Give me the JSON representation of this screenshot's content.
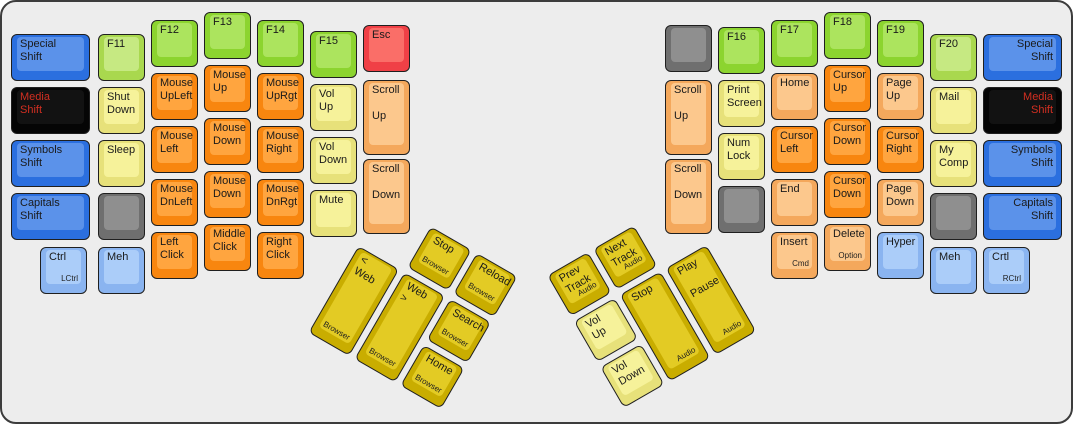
{
  "title": "ErgoDox media layer keyboard diagram",
  "palette": {
    "blue": {
      "base": "#2b6fdf",
      "top": "#5b92ea"
    },
    "lightblue": {
      "base": "#8ab4f0",
      "top": "#abcdf9"
    },
    "black": {
      "base": "#050505",
      "top": "#121212"
    },
    "green": {
      "base": "#8cd42f",
      "top": "#ace45e"
    },
    "ygreen": {
      "base": "#a9d84e",
      "top": "#c6e982"
    },
    "orange": {
      "base": "#f8860f",
      "top": "#ffa53f"
    },
    "peach": {
      "base": "#f4a85c",
      "top": "#fcc88d"
    },
    "paleyellow": {
      "base": "#e7e17a",
      "top": "#f6f29a"
    },
    "gold": {
      "base": "#c9ad00",
      "top": "#e3cb24"
    },
    "red": {
      "base": "#f04046",
      "top": "#fa6e68"
    },
    "gray": {
      "base": "#6f6f6f",
      "top": "#8f8f8f"
    }
  },
  "text_colors": {
    "default": "#1a1a1a",
    "red": "#d22f21"
  },
  "board": {
    "width": 1069,
    "height": 420,
    "background": "#ededed",
    "key_unit": 53,
    "key_size": 47
  },
  "groups": [
    {
      "name": "left-main",
      "type": "flat",
      "keys": [
        {
          "id": "special-shift-left",
          "x": 9,
          "y": 32,
          "w": 79,
          "c": "blue",
          "t": "Special\nShift"
        },
        {
          "id": "media-shift-left",
          "x": 9,
          "y": 85,
          "w": 79,
          "c": "black",
          "t": "Media\nShift",
          "tc": "red"
        },
        {
          "id": "symbols-shift-left",
          "x": 9,
          "y": 138,
          "w": 79,
          "c": "blue",
          "t": "Symbols\nShift"
        },
        {
          "id": "capitals-shift-left",
          "x": 9,
          "y": 191,
          "w": 79,
          "c": "blue",
          "t": "Capitals\nShift"
        },
        {
          "id": "lctrl",
          "x": 38,
          "y": 245,
          "c": "lightblue",
          "t": "Ctrl",
          "s": "LCtrl",
          "sp": "br"
        },
        {
          "id": "f11",
          "x": 96,
          "y": 32,
          "c": "ygreen",
          "t": "F11"
        },
        {
          "id": "shut-down",
          "x": 96,
          "y": 85,
          "c": "paleyellow",
          "t": "Shut\nDown"
        },
        {
          "id": "sleep",
          "x": 96,
          "y": 138,
          "c": "paleyellow",
          "t": "Sleep"
        },
        {
          "id": "blank-left",
          "x": 96,
          "y": 191,
          "c": "gray",
          "t": ""
        },
        {
          "id": "meh-left",
          "x": 96,
          "y": 245,
          "c": "lightblue",
          "t": "Meh"
        },
        {
          "id": "f12",
          "x": 149,
          "y": 18,
          "c": "green",
          "t": "F12"
        },
        {
          "id": "mouse-upleft",
          "x": 149,
          "y": 71,
          "c": "orange",
          "t": "Mouse\nUpLeft"
        },
        {
          "id": "mouse-left",
          "x": 149,
          "y": 124,
          "c": "orange",
          "t": "Mouse\nLeft"
        },
        {
          "id": "mouse-dnleft",
          "x": 149,
          "y": 177,
          "c": "orange",
          "t": "Mouse\nDnLeft"
        },
        {
          "id": "left-click",
          "x": 149,
          "y": 230,
          "c": "orange",
          "t": "Left\nClick"
        },
        {
          "id": "f13",
          "x": 202,
          "y": 10,
          "c": "green",
          "t": "F13"
        },
        {
          "id": "mouse-up",
          "x": 202,
          "y": 63,
          "c": "orange",
          "t": "Mouse\nUp"
        },
        {
          "id": "mouse-down-1",
          "x": 202,
          "y": 116,
          "c": "orange",
          "t": "Mouse\nDown"
        },
        {
          "id": "mouse-down-2",
          "x": 202,
          "y": 169,
          "c": "orange",
          "t": "Mouse\nDown"
        },
        {
          "id": "middle-click",
          "x": 202,
          "y": 222,
          "c": "orange",
          "t": "Middle\nClick"
        },
        {
          "id": "f14",
          "x": 255,
          "y": 18,
          "c": "green",
          "t": "F14"
        },
        {
          "id": "mouse-uprgt",
          "x": 255,
          "y": 71,
          "c": "orange",
          "t": "Mouse\nUpRgt"
        },
        {
          "id": "mouse-right",
          "x": 255,
          "y": 124,
          "c": "orange",
          "t": "Mouse\nRight"
        },
        {
          "id": "mouse-dnrgt",
          "x": 255,
          "y": 177,
          "c": "orange",
          "t": "Mouse\nDnRgt"
        },
        {
          "id": "right-click",
          "x": 255,
          "y": 230,
          "c": "orange",
          "t": "Right\nClick"
        },
        {
          "id": "f15",
          "x": 308,
          "y": 29,
          "c": "green",
          "t": "F15"
        },
        {
          "id": "vol-up-left",
          "x": 308,
          "y": 82,
          "c": "paleyellow",
          "t": "Vol\nUp"
        },
        {
          "id": "vol-down-left",
          "x": 308,
          "y": 135,
          "c": "paleyellow",
          "t": "Vol\nDown"
        },
        {
          "id": "mute",
          "x": 308,
          "y": 188,
          "c": "paleyellow",
          "t": "Mute"
        },
        {
          "id": "esc",
          "x": 361,
          "y": 23,
          "c": "red",
          "t": "Esc"
        },
        {
          "id": "scroll-up-left",
          "x": 361,
          "y": 78,
          "h": 75,
          "c": "peach",
          "t": "Scroll\n\nUp"
        },
        {
          "id": "scroll-down-left",
          "x": 361,
          "y": 157,
          "h": 75,
          "c": "peach",
          "t": "Scroll\n\nDown"
        }
      ]
    },
    {
      "name": "right-main",
      "type": "flat",
      "keys": [
        {
          "id": "blank-right-top",
          "x": 663,
          "y": 23,
          "c": "gray",
          "t": ""
        },
        {
          "id": "scroll-up-right",
          "x": 663,
          "y": 78,
          "h": 75,
          "c": "peach",
          "t": "Scroll\n\nUp"
        },
        {
          "id": "scroll-down-right",
          "x": 663,
          "y": 157,
          "h": 75,
          "c": "peach",
          "t": "Scroll\n\nDown"
        },
        {
          "id": "f16",
          "x": 716,
          "y": 25,
          "c": "green",
          "t": "F16"
        },
        {
          "id": "print-screen",
          "x": 716,
          "y": 78,
          "c": "paleyellow",
          "t": "Print\nScreen"
        },
        {
          "id": "num-lock",
          "x": 716,
          "y": 131,
          "c": "paleyellow",
          "t": "Num\nLock"
        },
        {
          "id": "blank-right-mid",
          "x": 716,
          "y": 184,
          "c": "gray",
          "t": ""
        },
        {
          "id": "f17",
          "x": 769,
          "y": 18,
          "c": "green",
          "t": "F17"
        },
        {
          "id": "home-right",
          "x": 769,
          "y": 71,
          "c": "peach",
          "t": "Home"
        },
        {
          "id": "cursor-left",
          "x": 769,
          "y": 124,
          "c": "orange",
          "t": "Cursor\nLeft"
        },
        {
          "id": "end",
          "x": 769,
          "y": 177,
          "c": "peach",
          "t": "End"
        },
        {
          "id": "insert",
          "x": 769,
          "y": 230,
          "c": "peach",
          "t": "Insert",
          "s": "Cmd",
          "sp": "br"
        },
        {
          "id": "f18",
          "x": 822,
          "y": 10,
          "c": "green",
          "t": "F18"
        },
        {
          "id": "cursor-up",
          "x": 822,
          "y": 63,
          "c": "orange",
          "t": "Cursor\nUp"
        },
        {
          "id": "cursor-down-1",
          "x": 822,
          "y": 116,
          "c": "orange",
          "t": "Cursor\nDown"
        },
        {
          "id": "cursor-down-2",
          "x": 822,
          "y": 169,
          "c": "orange",
          "t": "Cursor\nDown"
        },
        {
          "id": "delete",
          "x": 822,
          "y": 222,
          "c": "peach",
          "t": "Delete",
          "s": "Option",
          "sp": "br"
        },
        {
          "id": "f19",
          "x": 875,
          "y": 18,
          "c": "green",
          "t": "F19"
        },
        {
          "id": "page-up",
          "x": 875,
          "y": 71,
          "c": "peach",
          "t": "Page\nUp"
        },
        {
          "id": "cursor-right",
          "x": 875,
          "y": 124,
          "c": "orange",
          "t": "Cursor\nRight"
        },
        {
          "id": "page-down",
          "x": 875,
          "y": 177,
          "c": "peach",
          "t": "Page\nDown"
        },
        {
          "id": "hyper",
          "x": 875,
          "y": 230,
          "c": "lightblue",
          "t": "Hyper"
        },
        {
          "id": "f20",
          "x": 928,
          "y": 32,
          "c": "ygreen",
          "t": "F20"
        },
        {
          "id": "mail",
          "x": 928,
          "y": 85,
          "c": "paleyellow",
          "t": "Mail"
        },
        {
          "id": "my-comp",
          "x": 928,
          "y": 138,
          "c": "paleyellow",
          "t": "My\nComp"
        },
        {
          "id": "blank-right-low",
          "x": 928,
          "y": 191,
          "c": "gray",
          "t": ""
        },
        {
          "id": "meh-right",
          "x": 928,
          "y": 245,
          "c": "lightblue",
          "t": "Meh"
        },
        {
          "id": "special-shift-right",
          "x": 981,
          "y": 32,
          "w": 79,
          "c": "blue",
          "t": "Special\nShift",
          "a": "r"
        },
        {
          "id": "media-shift-right",
          "x": 981,
          "y": 85,
          "w": 79,
          "c": "black",
          "t": "Media\nShift",
          "tc": "red",
          "a": "r"
        },
        {
          "id": "symbols-shift-right",
          "x": 981,
          "y": 138,
          "w": 79,
          "c": "blue",
          "t": "Symbols\nShift",
          "a": "r"
        },
        {
          "id": "capitals-shift-right",
          "x": 981,
          "y": 191,
          "w": 79,
          "c": "blue",
          "t": "Capitals\nShift",
          "a": "r"
        },
        {
          "id": "rctrl",
          "x": 981,
          "y": 245,
          "c": "lightblue",
          "t": "Crtl",
          "s": "RCtrl",
          "sp": "br"
        }
      ]
    },
    {
      "name": "left-thumb-cluster",
      "type": "rotated",
      "origin_x": 383,
      "origin_y": 198,
      "rotation": 30,
      "anchor": "0 0",
      "size": 159,
      "keys": [
        {
          "id": "browser-stop",
          "x": 53,
          "y": 0,
          "c": "gold",
          "t": "Stop",
          "s": "Browser",
          "sp": "bc"
        },
        {
          "id": "browser-reload",
          "x": 106,
          "y": 0,
          "c": "gold",
          "t": "Reload",
          "s": "Browser",
          "sp": "bc"
        },
        {
          "id": "web-back",
          "x": 0,
          "y": 53,
          "h": 100,
          "c": "gold",
          "t": "< Web",
          "s": "Browser",
          "sp": "bc"
        },
        {
          "id": "web-forward",
          "x": 53,
          "y": 53,
          "h": 100,
          "c": "gold",
          "t": "Web >",
          "s": "Browser",
          "sp": "bc"
        },
        {
          "id": "browser-search",
          "x": 106,
          "y": 53,
          "c": "gold",
          "t": "Search",
          "s": "Browser",
          "sp": "bc"
        },
        {
          "id": "browser-home",
          "x": 106,
          "y": 106,
          "c": "gold",
          "t": "Home",
          "s": "Browser",
          "sp": "bc"
        }
      ]
    },
    {
      "name": "right-thumb-cluster",
      "type": "rotated",
      "origin_x": 524,
      "origin_y": 194,
      "rotation": -30,
      "anchor": "100% 0",
      "size": 159,
      "keys": [
        {
          "id": "prev-track",
          "x": 0,
          "y": 0,
          "c": "gold",
          "t": "Prev\nTrack",
          "s": "Audio",
          "sp": "br"
        },
        {
          "id": "next-track",
          "x": 53,
          "y": 0,
          "c": "gold",
          "t": "Next\nTrack",
          "s": "Audio",
          "sp": "br"
        },
        {
          "id": "vol-up-thumb",
          "x": 0,
          "y": 53,
          "c": "paleyellow",
          "t": "Vol\nUp"
        },
        {
          "id": "vol-down-thumb",
          "x": 0,
          "y": 106,
          "c": "paleyellow",
          "t": "Vol\nDown"
        },
        {
          "id": "audio-stop",
          "x": 53,
          "y": 53,
          "h": 100,
          "c": "gold",
          "t": "Stop",
          "s": "Audio",
          "sp": "br"
        },
        {
          "id": "play-pause",
          "x": 106,
          "y": 53,
          "h": 100,
          "c": "gold",
          "t": "Play\n\nPause",
          "s": "Audio",
          "sp": "br"
        }
      ]
    }
  ]
}
